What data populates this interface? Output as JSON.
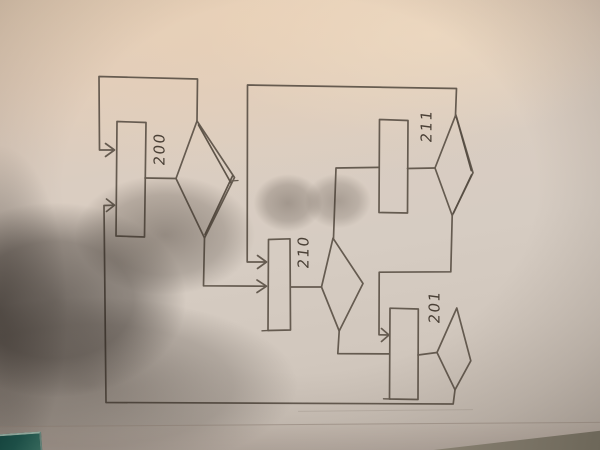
{
  "scene": {
    "type": "photograph of a hand-drawn flowchart on white paper, rotated 90 degrees",
    "paper_color": "#d9ccbf",
    "ink_color": "#5d5348",
    "dark_ink_color": "#4c4339",
    "shadow_color": "#2e2620",
    "table_color": "#7b7466",
    "teal_object_color": "#1d4f47",
    "label_color": "#4a4036"
  },
  "diagram": {
    "orientation": "labels written sideways, read bottom-to-top",
    "nodes": {
      "box200": {
        "label": "200",
        "shape": "rectangle"
      },
      "diamond200": {
        "label": "",
        "shape": "decision-diamond"
      },
      "box210": {
        "label": "210",
        "shape": "rectangle"
      },
      "diamond210": {
        "label": "",
        "shape": "decision-diamond"
      },
      "box211": {
        "label": "211",
        "shape": "rectangle"
      },
      "diamond211": {
        "label": "",
        "shape": "decision-diamond"
      },
      "box201": {
        "label": "201",
        "shape": "rectangle"
      },
      "diamond201": {
        "label": "",
        "shape": "decision-diamond"
      }
    },
    "edges": [
      {
        "from": "box200",
        "to": "diamond200",
        "arrow": false
      },
      {
        "from": "diamond200-top",
        "to": "box200-left",
        "arrow": true,
        "note": "self feedback loop over the top"
      },
      {
        "from": "diamond200-bottom",
        "to": "box210-left",
        "arrow": true
      },
      {
        "from": "diamond211-top",
        "to": "box210-left",
        "arrow": true,
        "note": "long feedback line across the top"
      },
      {
        "from": "box210",
        "to": "diamond210",
        "arrow": false
      },
      {
        "from": "diamond210-top",
        "to": "box211-left",
        "arrow": false
      },
      {
        "from": "box211",
        "to": "diamond211",
        "arrow": false
      },
      {
        "from": "diamond211-bottom",
        "to": "box201-left",
        "arrow": true
      },
      {
        "from": "diamond210-bottom",
        "to": "box201-left",
        "arrow": false
      },
      {
        "from": "box201",
        "to": "diamond201",
        "arrow": false
      },
      {
        "from": "diamond201-bottom",
        "to": "box200-left",
        "arrow": true,
        "note": "long feedback line across the bottom"
      }
    ]
  }
}
